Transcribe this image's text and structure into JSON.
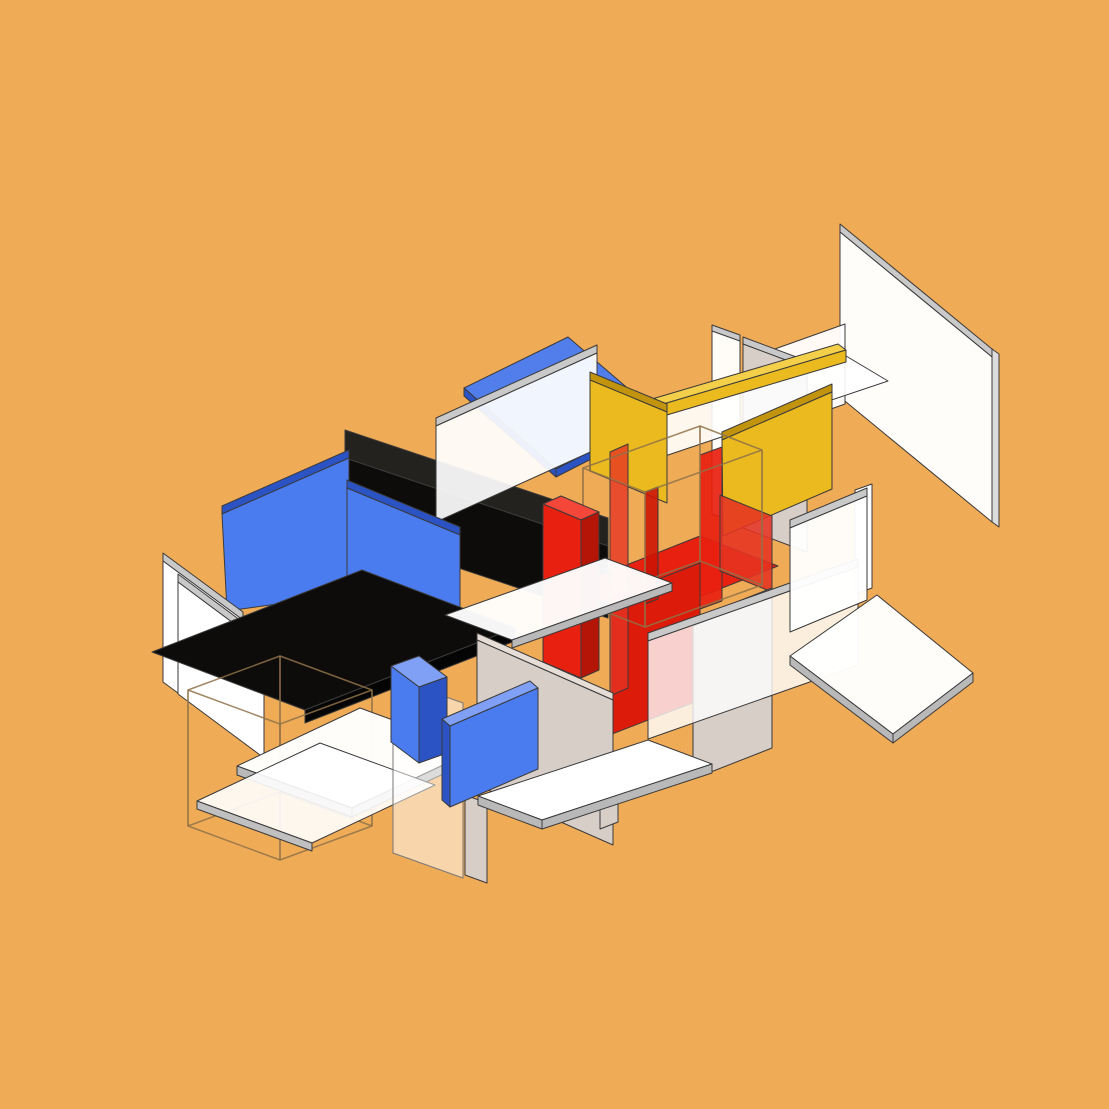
{
  "canvas": {
    "width": 1109,
    "height": 1109,
    "background": "#f0ab57"
  },
  "palette": {
    "background": "#f0ab57",
    "outline": "#3a3a3a",
    "wireframe": "#8f7248",
    "blue": "#4a7cf0",
    "blue_top": "#7fa0f4",
    "blue_dark": "#2b53c4",
    "red": "#e8200f",
    "red_top": "#f4473a",
    "red_dark": "#b41507",
    "yellow": "#eaba1e",
    "yellow_dark": "#c2940e",
    "yellow_light": "#f3cf4a",
    "black": "#0d0c0a",
    "white": "#ffffff",
    "taupe": "#d8cec8",
    "edge_gray": "#c9c9c9"
  },
  "scene": {
    "description": "Isometric exploded composition of Mondrian-style colored planes (white, blue, red, yellow, black, taupe) floating over an orange background, with two thin wireframe boxes.",
    "shapes": [
      {
        "name": "plane-topright-white-topband",
        "points": "840,224 992,349 992,357 840,232",
        "fill": "#c9c9c9"
      },
      {
        "name": "plane-topright-white-face",
        "points": "840,232 992,357 992,522 840,397",
        "fill": "#ffffff",
        "opacity": 0.97
      },
      {
        "name": "plane-topright-white-rightband",
        "points": "992,349 999,354 999,527 992,522",
        "fill": "#dcdcdc"
      },
      {
        "name": "plane-white-sliver-top",
        "points": "772,350 845,324 845,404 772,430",
        "fill": "#ffffff",
        "opacity": 0.94
      },
      {
        "name": "plane-white-tall-topband",
        "points": "712,325 740,335 740,342 712,332",
        "fill": "#c9c9c9"
      },
      {
        "name": "plane-white-tall-face",
        "points": "712,331 740,341 740,524 712,514",
        "fill": "#ffffff",
        "opacity": 0.95
      },
      {
        "name": "plane-taupe-tall-topband",
        "points": "743,337 807,361 807,368 743,344",
        "fill": "#c9c9c9"
      },
      {
        "name": "plane-taupe-tall-face",
        "points": "743,344 807,368 807,552 743,528",
        "fill": "#d8cec8"
      },
      {
        "name": "plane-white-roof-strip",
        "points": "618,428 841,353 888,381 665,456",
        "fill": "#ffffff",
        "opacity": 0.9
      },
      {
        "name": "beam-yellow-topface",
        "points": "652,399 838,344 846,350 660,405",
        "fill": "#f3cf4a"
      },
      {
        "name": "beam-yellow-face",
        "points": "660,405 846,350 846,362 660,417",
        "fill": "#eaba1e"
      },
      {
        "name": "roof-blue-face",
        "points": "568,337 660,416 556,469 464,388",
        "fill": "#4a7cf0",
        "opacity": 0.96
      },
      {
        "name": "roof-blue-edge-right",
        "points": "660,416 556,469 556,477 660,424",
        "fill": "#2b53c4"
      },
      {
        "name": "roof-blue-edge-left",
        "points": "464,388 556,469 556,477 464,396",
        "fill": "#2b53c4"
      },
      {
        "name": "beam-black-topface",
        "points": "345,430 608,518 608,546 345,458",
        "fill": "#23221e"
      },
      {
        "name": "beam-black-face",
        "points": "345,458 608,546 608,618 345,530",
        "fill": "#0d0c0a"
      },
      {
        "name": "pane-white-center-topband",
        "points": "436,418 597,345 597,353 436,426",
        "fill": "#c9c9c9"
      },
      {
        "name": "pane-white-center-face",
        "points": "436,426 597,353 597,449 436,522",
        "fill": "#ffffff",
        "opacity": 0.92
      },
      {
        "name": "plane-yellow-left-topband",
        "points": "590,372 667,404 667,412 590,380",
        "fill": "#c2940e"
      },
      {
        "name": "plane-yellow-left-face",
        "points": "590,380 667,412 667,503 590,471",
        "fill": "#eaba1e"
      },
      {
        "name": "panel-blue-left-topband",
        "points": "222,506 349,450 349,458 222,514",
        "fill": "#2b53c4"
      },
      {
        "name": "panel-blue-left-face",
        "points": "222,514 349,458 349,594 227,611",
        "fill": "#4a7cf0"
      },
      {
        "name": "panel-blue-mid-topband",
        "points": "347,480 460,527 460,535 347,488",
        "fill": "#2b53c4"
      },
      {
        "name": "panel-blue-mid-face",
        "points": "347,488 460,535 460,640 347,593",
        "fill": "#4a7cf0"
      },
      {
        "name": "panel-white-far-left-topband",
        "points": "163,553 243,612 243,620 163,561",
        "fill": "#c9c9c9"
      },
      {
        "name": "panel-white-far-left-face",
        "points": "163,561 243,620 243,741 163,682",
        "fill": "#ffffff"
      },
      {
        "name": "panel-white-far-left2-topband",
        "points": "178,574 264,638 264,646 178,582",
        "fill": "#c9c9c9"
      },
      {
        "name": "panel-white-far-left2-face",
        "points": "178,582 264,646 264,758 178,694",
        "fill": "#ffffff"
      },
      {
        "name": "floor-black-face",
        "points": "152,652 362,570 515,628 305,710",
        "fill": "#0d0c0a"
      },
      {
        "name": "floor-black-frontband",
        "points": "305,710 515,628 515,641 305,723",
        "fill": "#050505"
      },
      {
        "name": "wirebox-left-top",
        "points": "188,690 280,656 372,690 280,724",
        "fill": "none",
        "stroke": "#8f7248",
        "strokeWidth": 1.5,
        "strokeOpacity": 0.85
      },
      {
        "name": "wirebox-left-bottom",
        "points": "188,826 280,792 372,826 280,860",
        "fill": "none",
        "stroke": "#8f7248",
        "strokeWidth": 1.5,
        "strokeOpacity": 0.85
      },
      {
        "name": "wirebox-left-edge",
        "kind": "line",
        "x1": 188,
        "y1": 690,
        "x2": 188,
        "y2": 826,
        "stroke": "#8f7248",
        "strokeWidth": 1.5
      },
      {
        "name": "wirebox-left-edge",
        "kind": "line",
        "x1": 280,
        "y1": 656,
        "x2": 280,
        "y2": 792,
        "stroke": "#8f7248",
        "strokeWidth": 1.5
      },
      {
        "name": "wirebox-left-edge",
        "kind": "line",
        "x1": 372,
        "y1": 690,
        "x2": 372,
        "y2": 826,
        "stroke": "#8f7248",
        "strokeWidth": 1.5
      },
      {
        "name": "wirebox-left-edge",
        "kind": "line",
        "x1": 280,
        "y1": 724,
        "x2": 280,
        "y2": 860,
        "stroke": "#8f7248",
        "strokeWidth": 1.5
      },
      {
        "name": "floor-bottomleft-upper-face",
        "points": "360,708 475,750 352,808 237,766",
        "fill": "#ffffff",
        "opacity": 0.97
      },
      {
        "name": "floor-bottomleft-upper-band-l",
        "points": "237,766 352,808 352,817 237,775",
        "fill": "#b9b9b9"
      },
      {
        "name": "floor-bottomleft-upper-band-r",
        "points": "352,808 475,750 475,759 352,817",
        "fill": "#b9b9b9"
      },
      {
        "name": "floor-bottomleft-lower-face",
        "points": "320,743 435,785 312,843 197,801",
        "fill": "#ffffff",
        "opacity": 0.9
      },
      {
        "name": "floor-bottomleft-lower-band",
        "points": "197,801 312,843 312,851 197,809",
        "fill": "#c0c0c0"
      },
      {
        "name": "panel-translucent-bottomleft",
        "points": "393,678 463,703 463,878 393,853",
        "fill": "#ffffff",
        "opacity": 0.5,
        "stroke": "#777777"
      },
      {
        "name": "plane-yellow-right-topband",
        "points": "722,432 832,384 832,392 722,440",
        "fill": "#c2940e"
      },
      {
        "name": "plane-yellow-right-face",
        "points": "722,440 832,392 832,489 723,536",
        "fill": "#eaba1e"
      },
      {
        "name": "floor-red-face",
        "points": "568,588 700,536 778,566 646,618",
        "fill": "#e8200f"
      },
      {
        "name": "wall-red-apron",
        "points": "612,597 700,563 700,700 612,734",
        "fill": "#dd1b0b"
      },
      {
        "name": "wall-red-thin-1",
        "points": "700,455 722,447 722,601 700,609",
        "fill": "#e8200f",
        "opacity": 0.92
      },
      {
        "name": "wall-red-thin-2",
        "points": "720,495 772,516 772,592 720,571",
        "fill": "#e53322",
        "opacity": 0.88
      },
      {
        "name": "wall-red-thin-3",
        "points": "610,452 628,444 628,688 610,696",
        "fill": "#e53322",
        "opacity": 0.78
      },
      {
        "name": "wall-red-thin-4",
        "points": "645,492 658,487 658,599 645,604",
        "fill": "#cc1505",
        "opacity": 0.9
      },
      {
        "name": "wirebox-center-top",
        "points": "583,468 700,426 762,450 645,492",
        "fill": "none",
        "stroke": "#8f7248",
        "strokeWidth": 1.5,
        "strokeOpacity": 0.85
      },
      {
        "name": "wirebox-center-bottom",
        "points": "583,603 700,561 762,585 645,627",
        "fill": "none",
        "stroke": "#8f7248",
        "strokeWidth": 1.5,
        "strokeOpacity": 0.85
      },
      {
        "name": "wirebox-center-edge",
        "kind": "line",
        "x1": 583,
        "y1": 468,
        "x2": 583,
        "y2": 603,
        "stroke": "#8f7248",
        "strokeWidth": 1.5
      },
      {
        "name": "wirebox-center-edge",
        "kind": "line",
        "x1": 700,
        "y1": 426,
        "x2": 700,
        "y2": 561,
        "stroke": "#8f7248",
        "strokeWidth": 1.5
      },
      {
        "name": "wirebox-center-edge",
        "kind": "line",
        "x1": 762,
        "y1": 450,
        "x2": 762,
        "y2": 585,
        "stroke": "#8f7248",
        "strokeWidth": 1.5
      },
      {
        "name": "wirebox-center-edge",
        "kind": "line",
        "x1": 645,
        "y1": 492,
        "x2": 645,
        "y2": 627,
        "stroke": "#8f7248",
        "strokeWidth": 1.5
      },
      {
        "name": "pillar-red-topface",
        "points": "543,504 561,496 599,512 581,520",
        "fill": "#f4473a"
      },
      {
        "name": "pillar-red-frontface",
        "points": "543,504 581,520 581,678 543,662",
        "fill": "#e8200f"
      },
      {
        "name": "pillar-red-sideface",
        "points": "581,520 599,512 599,670 581,678",
        "fill": "#b41507"
      },
      {
        "name": "shelf-white-mid-face",
        "points": "445,615 605,558 672,583 512,640",
        "fill": "#ffffff",
        "opacity": 0.96
      },
      {
        "name": "shelf-white-mid-band",
        "points": "512,640 672,583 672,591 512,648",
        "fill": "#b9b9b9"
      },
      {
        "name": "wall-taupe-left-topband",
        "points": "477,633 613,693 613,700 477,640",
        "fill": "#e6ddd7"
      },
      {
        "name": "wall-taupe-left-face",
        "points": "477,640 613,700 613,845 477,785",
        "fill": "#d8cec8"
      },
      {
        "name": "wall-taupe-right-topband",
        "points": "693,619 772,588 772,595 693,626",
        "fill": "#e6ddd7"
      },
      {
        "name": "wall-taupe-right-face",
        "points": "693,626 772,595 772,748 693,779",
        "fill": "#d8cec8"
      },
      {
        "name": "plank-white-right-of-red",
        "points": "855,490 872,484 872,588 855,594",
        "fill": "#ffffff"
      },
      {
        "name": "pane-white-front-topband",
        "points": "648,633 858,559 858,567 648,641",
        "fill": "#c9c9c9"
      },
      {
        "name": "pane-white-front-face",
        "points": "648,641 858,567 858,665 648,739",
        "fill": "#ffffff",
        "opacity": 0.8
      },
      {
        "name": "wall-white-right-topband",
        "points": "790,520 867,488 867,496 790,528",
        "fill": "#c9c9c9"
      },
      {
        "name": "wall-white-right-face",
        "points": "790,528 867,496 867,600 790,632",
        "fill": "#ffffff",
        "opacity": 0.95
      },
      {
        "name": "floor-white-frontright-face",
        "points": "877,595 973,673 893,734 790,656",
        "fill": "#ffffff",
        "opacity": 0.97
      },
      {
        "name": "floor-white-frontright-band-l",
        "points": "790,656 893,734 893,743 790,665",
        "fill": "#b9b9b9"
      },
      {
        "name": "floor-white-frontright-band-r",
        "points": "893,734 973,673 973,682 893,743",
        "fill": "#b9b9b9"
      },
      {
        "name": "leg-taupe-right",
        "points": "600,770 618,763 618,822 600,829",
        "fill": "#d8cec8"
      },
      {
        "name": "leg-taupe-left",
        "points": "465,795 487,803 487,883 465,875",
        "fill": "#d8cec8"
      },
      {
        "name": "shelf-white-long-face",
        "points": "478,796 648,740 712,764 542,820",
        "fill": "#ffffff"
      },
      {
        "name": "shelf-white-long-band-l",
        "points": "478,796 542,820 542,829 478,805",
        "fill": "#b9b9b9"
      },
      {
        "name": "shelf-white-long-band-r",
        "points": "542,820 712,764 712,773 542,829",
        "fill": "#b9b9b9"
      },
      {
        "name": "box-blue-topface",
        "points": "391,666 419,656 447,677 419,687",
        "fill": "#7fa0f4"
      },
      {
        "name": "box-blue-frontface",
        "points": "391,666 419,687 419,763 391,742",
        "fill": "#4a7cf0"
      },
      {
        "name": "box-blue-sideface",
        "points": "419,687 447,677 447,753 419,763",
        "fill": "#2b53c4"
      },
      {
        "name": "slab-blue-topface",
        "points": "442,719 530,681 538,688 450,726",
        "fill": "#7fa0f4"
      },
      {
        "name": "slab-blue-leftedge",
        "points": "442,719 450,726 450,807 442,800",
        "fill": "#2b53c4"
      },
      {
        "name": "slab-blue-face",
        "points": "450,726 538,688 538,769 450,807",
        "fill": "#4a7cf0"
      }
    ]
  }
}
